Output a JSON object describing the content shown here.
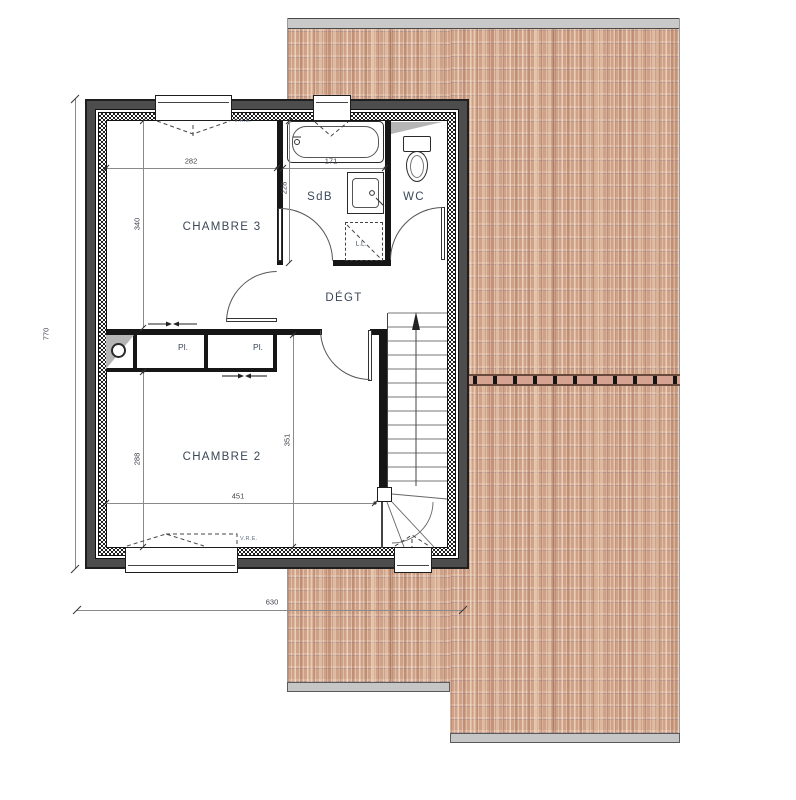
{
  "rooms": {
    "chambre3": "CHAMBRE 3",
    "sdb": "SdB",
    "wc": "WC",
    "degt": "DÉGT",
    "chambre2": "CHAMBRE 2"
  },
  "closets": {
    "pl1": "Pl.",
    "pl2": "Pl."
  },
  "appliances": {
    "lave_linge": "L.L."
  },
  "window_marks": {
    "vre_top": "V.R.E.",
    "vre_bottom": "V.R.E."
  },
  "dimensions": {
    "chambre3_width": "282",
    "chambre3_height": "340",
    "sdb_height": "228",
    "bathtub_width": "171",
    "chambre2_height_left": "288",
    "degt_height": "351",
    "chambre2_width": "451",
    "overall_width": "630",
    "overall_height": "770"
  },
  "colors": {
    "wall": "#4d4d4d",
    "roof_tile": "#cfa287",
    "ridge": "#d6a392",
    "label_text": "#3a4757",
    "dim_text": "#3f434c"
  }
}
